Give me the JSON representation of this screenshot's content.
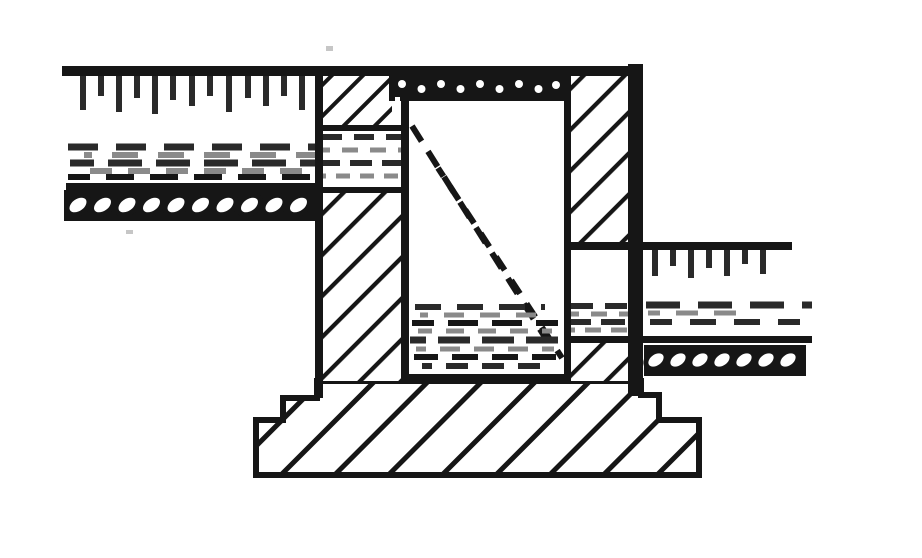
{
  "diagram": {
    "type": "engineering cross-section drawing, monochrome line art, no text labels",
    "colors": {
      "paper": "#ffffff",
      "ink": "#161616",
      "ink_soft": "#2a2a2a",
      "gray": "#8a8a8a",
      "speck": "#c6c6c6"
    },
    "elements": {
      "left_ground": "upper ground surface line with hatch tick marks (left side)",
      "left_strata": "dashed soil stratum band and oval gravel band (left side)",
      "left_wall": "hatched wall section (left) with dashed stratum band crossing it",
      "top_cap": "dark rubble/packing strip across the top of the central opening",
      "shaft": "central white opening with diagonal dashed glass-style lines and dashed fill near the bottom",
      "right_wall": "hatched wall section (right) with thick black outer edge",
      "right_ground": "lower ground surface line with hatch tick marks (right side)",
      "right_strata": "dashed soil stratum band and oval gravel band (right side)",
      "footing": "wide stepped foundation footing with coarse diagonal hatching"
    }
  }
}
